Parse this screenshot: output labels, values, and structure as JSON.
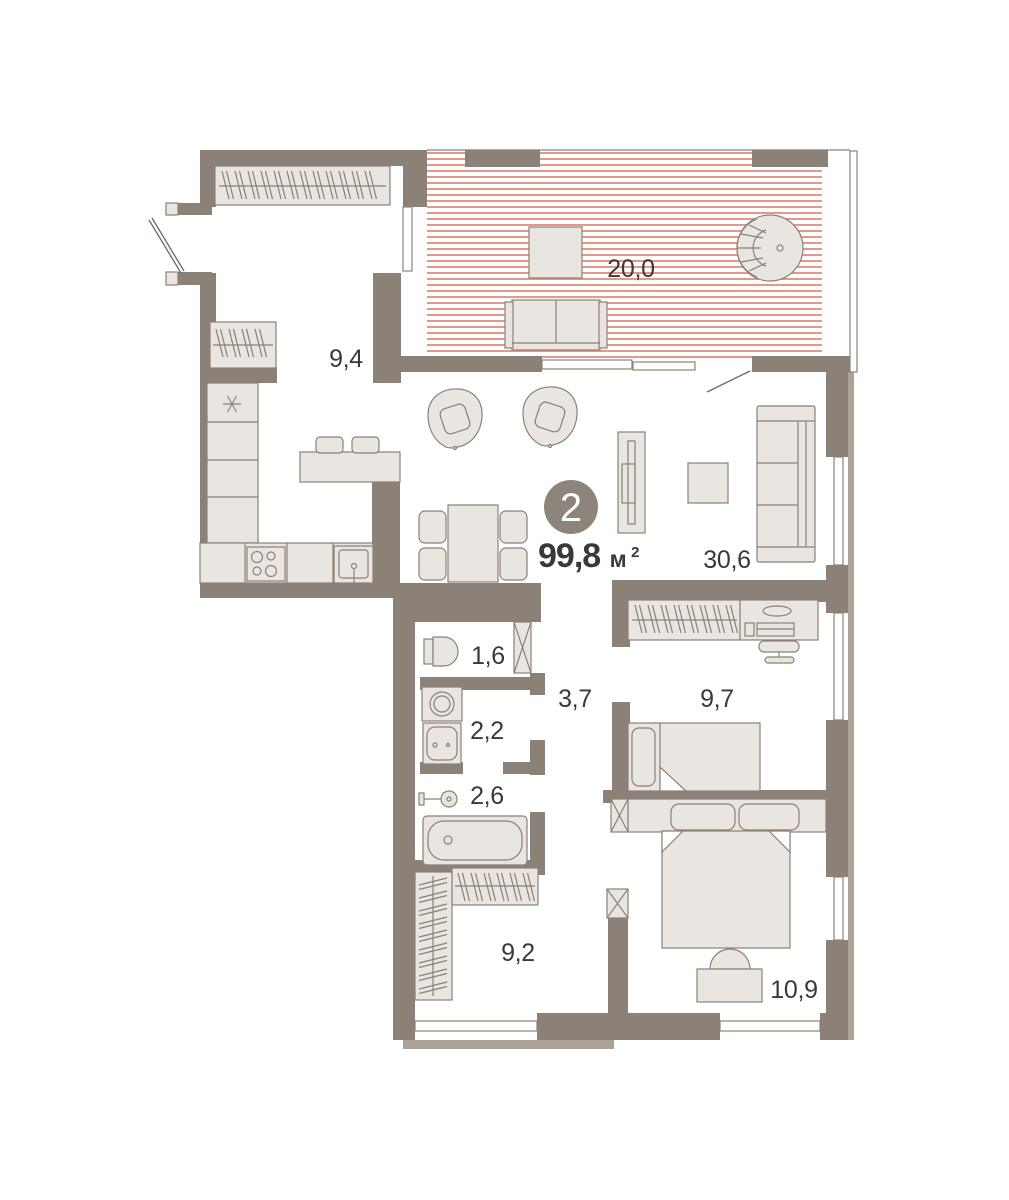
{
  "floorplan": {
    "badge": {
      "rooms_count": "2",
      "area_value": "99,8",
      "area_unit": "м",
      "area_exponent": "2"
    },
    "rooms": [
      {
        "name": "hall",
        "area": "9,4"
      },
      {
        "name": "terrace",
        "area": "20,0"
      },
      {
        "name": "kitchen-living-room",
        "area": "30,6"
      },
      {
        "name": "wc",
        "area": "1,6"
      },
      {
        "name": "laundry-bathroom",
        "area": "2,2"
      },
      {
        "name": "bathroom",
        "area": "2,6"
      },
      {
        "name": "hallway",
        "area": "3,7"
      },
      {
        "name": "bedroom",
        "area": "9,7"
      },
      {
        "name": "wardrobe-hall",
        "area": "9,2"
      },
      {
        "name": "master-bedroom",
        "area": "10,9"
      }
    ],
    "colors": {
      "wall": "#8C8176",
      "wall_light": "#ACA296",
      "furniture_fill": "#E9E5E0",
      "furniture_stroke": "#8C8176",
      "hatch": "#DE8573",
      "door_line": "#6F6860",
      "badge_bg": "#8D857B",
      "badge_text": "#FFFFFF",
      "label_text": "#3B3936"
    }
  }
}
